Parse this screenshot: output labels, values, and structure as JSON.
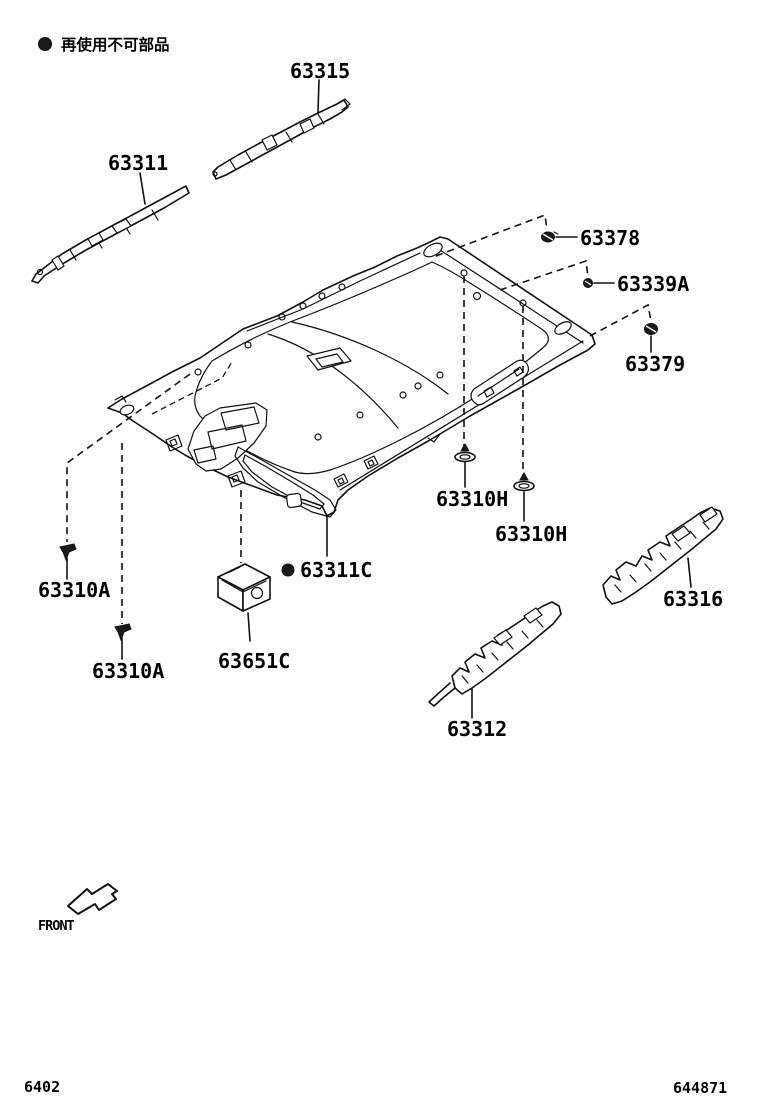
{
  "legend": {
    "marker": "non-reusable-dot",
    "text": "再使用不可部品"
  },
  "callouts": {
    "c63315": {
      "label": "63315"
    },
    "c63311": {
      "label": "63311"
    },
    "c63378": {
      "label": "63378"
    },
    "c63339A": {
      "label": "63339A"
    },
    "c63379": {
      "label": "63379"
    },
    "c63310H_rear": {
      "label": "63310H"
    },
    "c63310H_front": {
      "label": "63310H"
    },
    "c63311C": {
      "label": "63311C",
      "non_reusable_marker": true
    },
    "c63310A_left": {
      "label": "63310A"
    },
    "c63310A_right": {
      "label": "63310A"
    },
    "c63651C": {
      "label": "63651C"
    },
    "c63316": {
      "label": "63316"
    },
    "c63312": {
      "label": "63312"
    }
  },
  "front_indicator": {
    "label": "FRONT"
  },
  "footer": {
    "left_code": "6402",
    "right_code": "644871"
  },
  "colors": {
    "line": "#111111",
    "background": "#ffffff",
    "text": "#000000"
  }
}
